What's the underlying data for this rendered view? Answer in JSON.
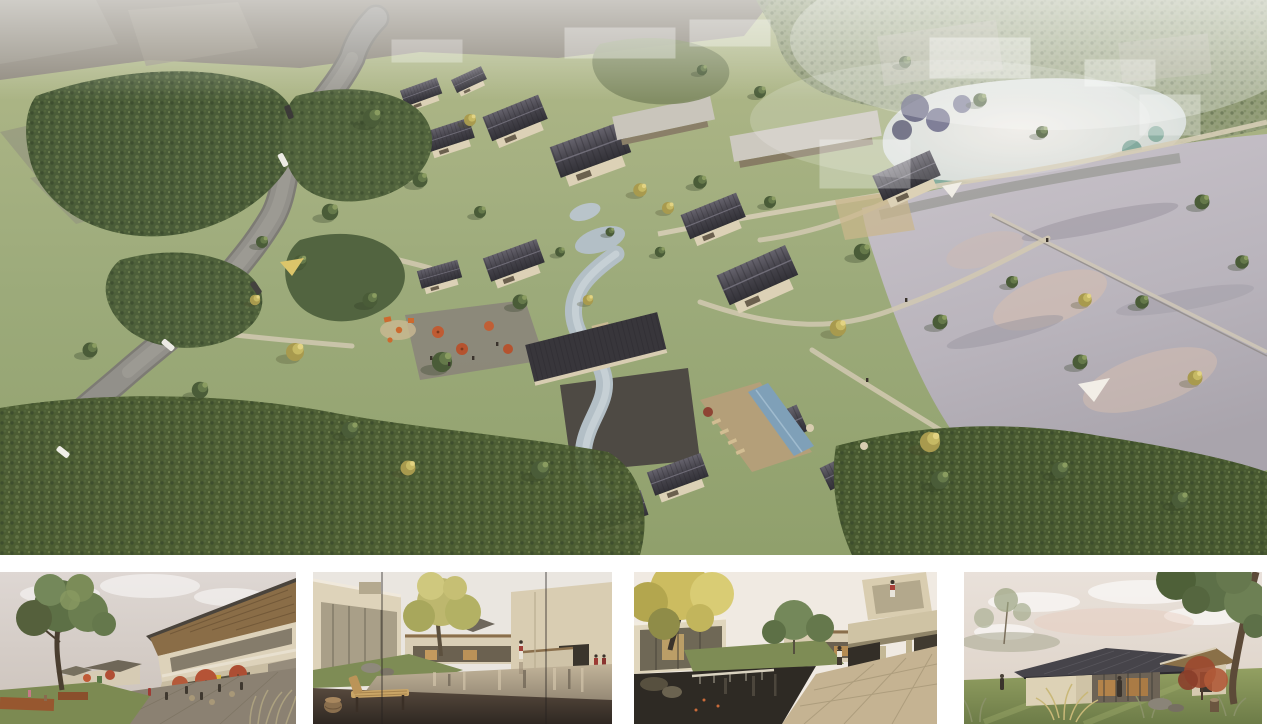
{
  "page": {
    "background": "#ffffff"
  },
  "main_panel": {
    "name": "aerial-masterplan-rendering",
    "label": "Aerial rendering of a lakeside village of courtyard houses with dark pitched roofs, a winding road, central stream, cafe plaza, lap pool, two ponds and surrounding woodland"
  },
  "thumbnails": [
    {
      "name": "street-cafe-view",
      "label": "Eye-level street view with cafe umbrellas, terraces, shade tree and two-storey timber-roofed buildings"
    },
    {
      "name": "courtyard-pond-view",
      "label": "Courtyard reflecting pond seen past a wooden bench and stool, glass facades left and right"
    },
    {
      "name": "water-court-view",
      "label": "Water court with stone weir, autumn birch, colonnade and cantilevered balcony with a visitor"
    },
    {
      "name": "lawn-pavilion-view",
      "label": "Single-storey glass pavilion with dark hipped roof on an open lawn, framed by trees and grasses"
    }
  ],
  "palette": {
    "grass": "#9dab7b",
    "forest": "#4a5c38",
    "forest_light": "#7e8a62",
    "autumn": "#c6b964",
    "roof": "#3b3a41",
    "roof_light": "#615e68",
    "wall": "#dcd1b6",
    "glass": "#6b604e",
    "road": "#92908a",
    "field": "#8c867a",
    "lake": "#b9b4bc",
    "lake_pink": "#d9bfae",
    "pond": "#ccd4cf",
    "pond_teal": "#6fa08e",
    "reflection_navy": "#3f3f63",
    "stream": "#b3bfc6",
    "pool": "#7fa0b8",
    "deck": "#b49f79",
    "plaza": "#8b8172",
    "umbrella": "#b55336",
    "corten": "#97572f",
    "sail": "#dcc56a",
    "sky": "#ded7d3",
    "bench": "#c9a566",
    "water_dark": "#2e2a24",
    "terrace": "#c5b392"
  }
}
